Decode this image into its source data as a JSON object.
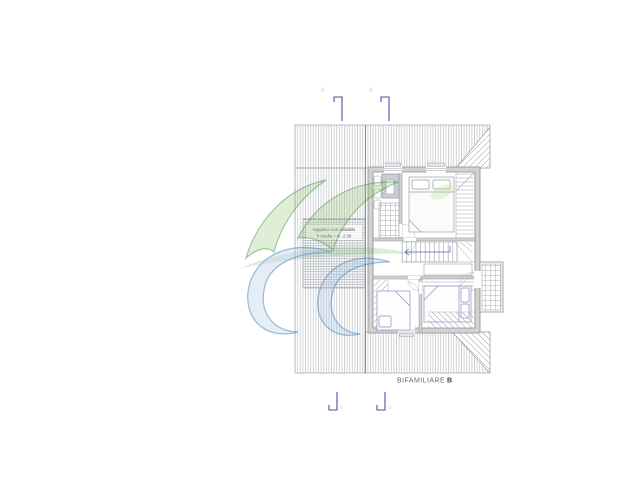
{
  "plan": {
    "title": {
      "text": "BIFAMILIARE",
      "suffix_bold": "B"
    },
    "mezzanine_note": {
      "line1": "soppalco non abitabile",
      "line2": "h media = m. 2.00"
    },
    "section_markers": {
      "top_left_label": "b",
      "top_right_label": "d",
      "bottom_left_label": "b",
      "bottom_right_label": "d"
    }
  },
  "colors": {
    "background": "#ffffff",
    "roof_hatch": "#b7bbbf",
    "roof_outline": "#9ca2a8",
    "wall_fill": "#d2d2d2",
    "wall_stroke": "#8f8f8f",
    "furniture_stroke": "#9aa0a8",
    "bed_accent": "#8890c8",
    "section_marker_blue": "#4a50a0",
    "marker_letter_gray": "#c9cdd6",
    "label_text": "#6a6e72",
    "watermark_green": "#3f8f46",
    "watermark_blue": "#3c7cb4"
  }
}
